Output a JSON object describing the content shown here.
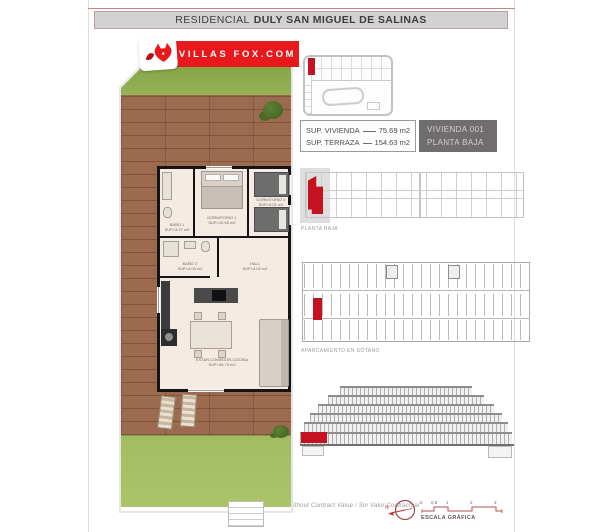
{
  "header": {
    "title_prefix": "RESIDENCIAL",
    "title_main": "DULY SAN MIGUEL DE SALINAS"
  },
  "logo": {
    "text": "VILLAS FOX.COM"
  },
  "summary": {
    "rows": [
      {
        "label": "SUP. VIVIENDA",
        "value": "75.69 m2"
      },
      {
        "label": "SUP. TERRAZA",
        "value": "154.63 m2"
      }
    ],
    "unit": {
      "line1": "VIVIENDA 001",
      "line2": "PLANTA BAJA"
    }
  },
  "floorplan": {
    "rooms": [
      {
        "name": "DORMITORIO 1",
        "area": "SUP=10.55 m2"
      },
      {
        "name": "DORMITORIO 2",
        "area": "SUP=9.01 m2"
      },
      {
        "name": "BAÑO 1",
        "area": "SUP=3.97 m2"
      },
      {
        "name": "BAÑO 2",
        "area": "SUP=4.03 m2"
      },
      {
        "name": "HALL",
        "area": "SUP=4.02 m2"
      },
      {
        "name": "ESTAR-COMEDOR-COCINA",
        "area": "SUP=28.73 m2"
      }
    ]
  },
  "diagrams": {
    "site_plan_label": "PLANTA BAJA",
    "parking_label": "APARCAMIENTO EN SÓTANO"
  },
  "footer": {
    "disclaimer": "* Without Contract Value / Sin Valor Contractual",
    "scale_label": "ESCALA GRÁFICA",
    "scale_ticks": [
      "0",
      "0.5",
      "1",
      "2",
      "3"
    ],
    "compass_label": "N"
  },
  "colors": {
    "brand_red": "#e8191c",
    "highlight_red": "#c41220",
    "grass_green": "#97b257",
    "wood_brown": "#9c6a4e"
  }
}
